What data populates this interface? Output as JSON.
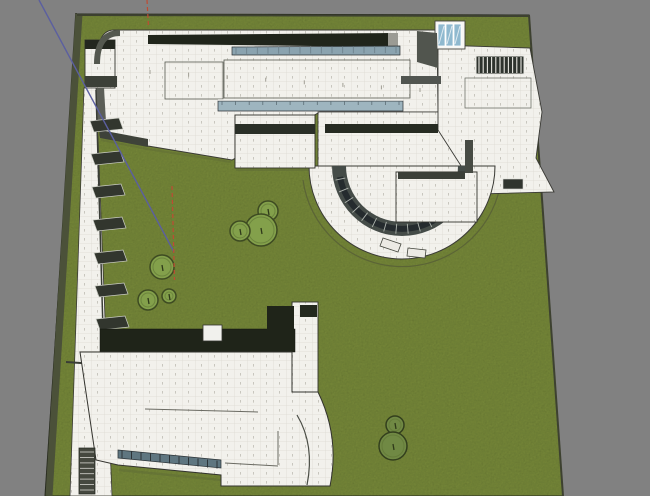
{
  "viewport": {
    "width": 650,
    "height": 496,
    "background_color": "#818181",
    "description": "3d-model-viewport-top-view-museum-site"
  },
  "colors": {
    "grass": "#7c8e3e",
    "site_edge_band": "#4b5139",
    "site_edge_dark": "#2c2f23",
    "tile_white": "#f2f1ec",
    "tile_grid": "#dcdad2",
    "tile_tick": "#b7b4aa",
    "roof_dark": "#20251b",
    "glass_blue_1": "#8aa3af",
    "glass_blue_2": "#9eb5bf",
    "glass_strip_low": "#5f7680",
    "skylight_blue": "#8fb9cf",
    "atrium_glass": "#252b2e",
    "axis_blue": "#5b5fa0",
    "axis_red": "#bf4b33",
    "tree_fill": "#83a04b",
    "tree_stroke": "#3e4b22",
    "tree_dark_fill": "#708944",
    "shadow_green": "#5f6c36"
  },
  "site": {
    "corners": "77,14 529,15 563,496 45,496",
    "edge_band": {
      "d": "M79,14 L49,496",
      "outer": "M76,13 L46,495",
      "top": "M77,15 L529,16",
      "right": "M529,15 L563,496"
    }
  },
  "axes": {
    "blue": {
      "x1": 39,
      "y1": 0,
      "x2": 174,
      "y2": 252
    },
    "red_segments": [
      {
        "x1": 147,
        "y1": 0,
        "x2": 148.5,
        "y2": 27
      },
      {
        "x1": 172,
        "y1": 186,
        "x2": 174.5,
        "y2": 280
      }
    ],
    "red_dash": "4 3"
  },
  "trees": [
    {
      "cx": 268,
      "cy": 211,
      "r": 10,
      "dark": false
    },
    {
      "cx": 261,
      "cy": 230,
      "r": 16,
      "dark": false
    },
    {
      "cx": 240,
      "cy": 231,
      "r": 10,
      "dark": false
    },
    {
      "cx": 162,
      "cy": 267,
      "r": 12,
      "dark": false
    },
    {
      "cx": 148,
      "cy": 300,
      "r": 10,
      "dark": false
    },
    {
      "cx": 169,
      "cy": 296,
      "r": 7,
      "dark": false
    },
    {
      "cx": 395,
      "cy": 425,
      "r": 9,
      "dark": true
    },
    {
      "cx": 393,
      "cy": 446,
      "r": 14,
      "dark": true
    }
  ],
  "shapes": [
    {
      "n": "lawn-shadow-plaza-edge",
      "t": "polyline",
      "a": {
        "points": "101,140 147,149 231,162",
        "fill": "none",
        "stroke": "#5f6c36",
        "stroke-width": "2",
        "opacity": "0.5"
      }
    },
    {
      "n": "lawn-shadow-midblock",
      "t": "line",
      "a": {
        "x1": "236",
        "y1": "170",
        "x2": "315",
        "y2": "170",
        "stroke": "#5f6c36",
        "stroke-width": "2",
        "opacity": "0.5"
      }
    },
    {
      "n": "lawn-shadow-south-wing",
      "t": "line",
      "a": {
        "x1": "119",
        "y1": "470",
        "x2": "221",
        "y2": "480",
        "stroke": "#5f6c36",
        "stroke-width": "2.5",
        "opacity": "0.5"
      }
    },
    {
      "n": "lawn-shadow-rotunda",
      "t": "path",
      "a": {
        "d": "M321,213 A95,95 0 0 0 483,213",
        "fill": "none",
        "stroke": "#5f6c36",
        "stroke-width": "2",
        "opacity": "0.35"
      }
    },
    {
      "n": "rotunda-ground-path",
      "t": "path",
      "a": {
        "d": "M303,180 A100,100 0 0 0 500,187 L526,190",
        "fill": "none",
        "stroke": "#5b6436",
        "stroke-width": "1.2"
      }
    },
    {
      "n": "main-plaza-building",
      "t": "path",
      "a": {
        "d": "M114,30 L437,30 L438,112 L320,112 L232,160 L148,146 L100,136 L97,62 Q97,30 114,30 Z",
        "fill": "url(#tiles)",
        "stroke": "#3a3a35",
        "stroke-width": "0.9"
      }
    },
    {
      "n": "rotunda-upper-plaza",
      "t": "polygon",
      "a": {
        "points": "318,112 460,112 466,173 318,173",
        "fill": "url(#tiles)",
        "stroke": "#3a3a35",
        "stroke-width": "0.8"
      }
    },
    {
      "n": "east-wing-building",
      "t": "path",
      "a": {
        "d": "M438,45 L530,48 L542,112 L536,158 L554,192 L478,194 L465,172 L438,130 Z",
        "fill": "url(#tiles)",
        "stroke": "#3a3a35",
        "stroke-width": "0.9"
      }
    },
    {
      "n": "rotunda-half-disc",
      "t": "path",
      "a": {
        "d": "M309,166 A93,93 0 0 0 495,166 Z",
        "fill": "url(#tiles)",
        "stroke": "#3a3a35",
        "stroke-width": "1"
      }
    },
    {
      "n": "rotunda-glass-annulus",
      "t": "path",
      "a": {
        "d": "M332,166 A70,70 0 0 0 472,166 L458,166 A56,56 0 0 1 346,166 Z",
        "fill": "#454c48",
        "stroke": "none"
      }
    },
    {
      "n": "atrium-glass-arc",
      "t": "path",
      "a": {
        "d": "M340,177 A63,63 0 0 0 464,177",
        "fill": "none",
        "stroke": "#252b2e",
        "stroke-width": "6"
      }
    },
    {
      "n": "atrium-glass-mullions",
      "t": "radial",
      "cx": 402,
      "cy": 166,
      "r1": 58,
      "r2": 68,
      "a1": 168,
      "a2": 12,
      "count": 16,
      "a": {
        "stroke": "#aeb4ae",
        "stroke-width": "0.9"
      }
    },
    {
      "n": "rotunda-balcony-1",
      "t": "polygon",
      "a": {
        "points": "383,238 401,244 398,252 380,246",
        "fill": "#eceae4",
        "stroke": "#44463e",
        "stroke-width": "0.8"
      }
    },
    {
      "n": "rotunda-balcony-2",
      "t": "polygon",
      "a": {
        "points": "408,248 426,250 425,258 407,256",
        "fill": "#eceae4",
        "stroke": "#44463e",
        "stroke-width": "0.8"
      }
    },
    {
      "n": "rotunda-inner-block",
      "t": "rect",
      "a": {
        "x": "396",
        "y": "172",
        "width": "81",
        "height": "50",
        "fill": "url(#tiles)",
        "stroke": "#33332e",
        "stroke-width": "0.9"
      }
    },
    {
      "n": "rotunda-inner-block-roofband",
      "t": "rect",
      "a": {
        "x": "398",
        "y": "172",
        "width": "67",
        "height": "7",
        "fill": "#3b3f38"
      }
    },
    {
      "n": "rotunda-wall-band",
      "t": "rect",
      "a": {
        "x": "465",
        "y": "140",
        "width": "8",
        "height": "33",
        "fill": "#474b44"
      }
    },
    {
      "n": "east-wing-window-box",
      "t": "rect",
      "a": {
        "x": "503",
        "y": "179",
        "width": "20",
        "height": "10",
        "fill": "#30342e",
        "stroke": "#d8d8d2",
        "stroke-width": "0.6"
      }
    },
    {
      "n": "north-roof-dark-band",
      "t": "polygon",
      "a": {
        "points": "148,35 390,33 393,47 148,44",
        "fill": "#20251b"
      }
    },
    {
      "n": "north-roof-band-cap",
      "t": "rect",
      "a": {
        "x": "388",
        "y": "33",
        "width": "10",
        "height": "15",
        "fill": "#9b9b94"
      }
    },
    {
      "n": "clerestory-glass-upper",
      "t": "polygon",
      "a": {
        "points": "232,47 400,46 400,55 232,55",
        "fill": "#8aa3af",
        "stroke": "#2e3335",
        "stroke-width": "0.7"
      }
    },
    {
      "n": "clerestory-upper-mullions",
      "t": "series",
      "tag": "line",
      "count": 16,
      "from": {
        "x1": 236,
        "y1": 47,
        "x2": 236,
        "y2": 54
      },
      "to": {
        "x1": 396,
        "y1": 46,
        "x2": 396,
        "y2": 53
      },
      "a": {
        "stroke": "#6a7e88",
        "stroke-width": "0.8"
      }
    },
    {
      "n": "roof-outline-west",
      "t": "rect",
      "a": {
        "x": "165",
        "y": "62",
        "width": "58",
        "height": "37",
        "fill": "none",
        "stroke": "#55584f",
        "stroke-width": "0.8"
      }
    },
    {
      "n": "roof-outline-east",
      "t": "rect",
      "a": {
        "x": "224",
        "y": "60",
        "width": "186",
        "height": "38",
        "fill": "none",
        "stroke": "#55584f",
        "stroke-width": "0.8"
      }
    },
    {
      "n": "clerestory-glass-lower",
      "t": "polygon",
      "a": {
        "points": "218,101 403,101 403,111 218,111",
        "fill": "#9eb5bf",
        "stroke": "#2c3134",
        "stroke-width": "0.7"
      }
    },
    {
      "n": "clerestory-lower-highlight",
      "t": "line",
      "a": {
        "x1": "218",
        "y1": "100",
        "x2": "403",
        "y2": "100",
        "stroke": "#f5f5f2",
        "stroke-width": "1.4"
      }
    },
    {
      "n": "clerestory-lower-mullions",
      "t": "series",
      "tag": "line",
      "count": 14,
      "from": {
        "x1": 222,
        "y1": 101,
        "x2": 222,
        "y2": 105
      },
      "to": {
        "x1": 399,
        "y1": 101,
        "x2": 399,
        "y2": 105
      },
      "a": {
        "stroke": "#5d6e76",
        "stroke-width": "0.8"
      }
    },
    {
      "n": "south-dark-band-east",
      "t": "rect",
      "a": {
        "x": "325",
        "y": "124",
        "width": "113",
        "height": "9",
        "fill": "#262b22"
      }
    },
    {
      "n": "mid-gallery-block",
      "t": "rect",
      "a": {
        "x": "235",
        "y": "115",
        "width": "80",
        "height": "53",
        "fill": "url(#tiles)",
        "stroke": "#2f2f2a",
        "stroke-width": "0.9"
      }
    },
    {
      "n": "mid-gallery-roofband",
      "t": "rect",
      "a": {
        "x": "235",
        "y": "124",
        "width": "80",
        "height": "10",
        "fill": "#2a2f27"
      }
    },
    {
      "n": "skylight-box",
      "t": "rect",
      "a": {
        "x": "435",
        "y": "21",
        "width": "30",
        "height": "28",
        "fill": "#f7f7f4",
        "stroke": "#44443e",
        "stroke-width": "0.9"
      }
    },
    {
      "n": "skylight-panes",
      "t": "series",
      "tag": "rect",
      "count": 3,
      "from": {
        "x": 438,
        "y": 24,
        "width": 7,
        "height": 22
      },
      "to": {
        "x": 454,
        "y": 24,
        "width": 7,
        "height": 22
      },
      "a": {
        "fill": "#8fb9cf",
        "stroke": "#ffffff",
        "stroke-width": "0.8"
      }
    },
    {
      "n": "skylight-glints",
      "t": "series",
      "tag": "line",
      "count": 3,
      "from": {
        "x1": 444,
        "y1": 26,
        "x2": 439,
        "y2": 44
      },
      "to": {
        "x1": 460,
        "y1": 26,
        "x2": 455,
        "y2": 44
      },
      "a": {
        "stroke": "#dce9f0",
        "stroke-width": "1"
      }
    },
    {
      "n": "dark-wall-wedge",
      "t": "polygon",
      "a": {
        "points": "417,31 437,33 438,68 417,62",
        "fill": "#51554e"
      }
    },
    {
      "n": "louver-pergola",
      "t": "rect",
      "a": {
        "x": "476",
        "y": "56",
        "width": "48",
        "height": "18",
        "fill": "#2e332d",
        "stroke": "#e9e9e3",
        "stroke-width": "1"
      }
    },
    {
      "n": "louver-slats",
      "t": "series",
      "tag": "line",
      "count": 11,
      "from": {
        "x1": 479,
        "y1": 57,
        "x2": 479,
        "y2": 73
      },
      "to": {
        "x1": 521,
        "y1": 57,
        "x2": 521,
        "y2": 73
      },
      "a": {
        "stroke": "#e8e8e2",
        "stroke-width": "1.1"
      }
    },
    {
      "n": "east-wing-band",
      "t": "rect",
      "a": {
        "x": "401",
        "y": "76",
        "width": "40",
        "height": "8",
        "fill": "#515550"
      }
    },
    {
      "n": "east-wing-roof-outline",
      "t": "rect",
      "a": {
        "x": "465",
        "y": "78",
        "width": "66",
        "height": "30",
        "fill": "none",
        "stroke": "#60635a",
        "stroke-width": "0.7"
      }
    },
    {
      "n": "gatehouse-building",
      "t": "rect",
      "a": {
        "x": "85",
        "y": "40",
        "width": "30",
        "height": "48",
        "fill": "url(#tiles)",
        "stroke": "#33332e",
        "stroke-width": "0.9"
      }
    },
    {
      "n": "gatehouse-roofband",
      "t": "rect",
      "a": {
        "x": "85",
        "y": "40",
        "width": "30",
        "height": "9",
        "fill": "#23271f"
      }
    },
    {
      "n": "gatehouse-base-band",
      "t": "rect",
      "a": {
        "x": "85",
        "y": "76",
        "width": "32",
        "height": "11",
        "fill": "#3c4038"
      }
    },
    {
      "n": "gatehouse-wall-wedge",
      "t": "polygon",
      "a": {
        "points": "86,88 104,88 106,122 90,124",
        "fill": "#5c5f58"
      }
    },
    {
      "n": "plaza-corner-wall",
      "t": "path",
      "a": {
        "d": "M97,64 Q97,33 120,33",
        "fill": "none",
        "stroke": "#54584f",
        "stroke-width": "6"
      }
    },
    {
      "n": "plaza-south-wall-band",
      "t": "polygon",
      "a": {
        "points": "100,130 148,139 148,147 100,138",
        "fill": "#3e4239"
      }
    },
    {
      "n": "plaza-joint-ticks",
      "t": "series",
      "tag": "line",
      "count": 8,
      "from": {
        "x1": 150,
        "y1": 70,
        "x2": 150,
        "y2": 74
      },
      "to": {
        "x1": 420,
        "y1": 88,
        "x2": 420,
        "y2": 92
      },
      "a": {
        "stroke": "#a09e94",
        "stroke-width": "1"
      }
    },
    {
      "n": "west-colonnade-wall",
      "t": "polygon",
      "a": {
        "points": "84,88 96,88 112,496 70,496",
        "fill": "url(#tiles)",
        "stroke": "#3a3a35",
        "stroke-width": "0.8"
      }
    },
    {
      "n": "west-colonnade-edge",
      "t": "line",
      "a": {
        "x1": "96",
        "y1": "90",
        "x2": "103",
        "y2": "330",
        "stroke": "#3a3d36",
        "stroke-width": "1.5"
      }
    },
    {
      "n": "colonnade-pergola-1",
      "t": "polygon",
      "a": {
        "points": "90,121 119,118 123,129 94,132",
        "fill": "#32362e",
        "stroke": "#caccc4",
        "stroke-width": "0.7"
      }
    },
    {
      "n": "colonnade-pergola-2",
      "t": "polygon",
      "a": {
        "points": "91,154 120,151 124,162 95,165",
        "fill": "#32362e",
        "stroke": "#caccc4",
        "stroke-width": "0.7"
      }
    },
    {
      "n": "colonnade-pergola-3",
      "t": "polygon",
      "a": {
        "points": "92,187 121,184 125,195 96,198",
        "fill": "#32362e",
        "stroke": "#caccc4",
        "stroke-width": "0.7"
      }
    },
    {
      "n": "colonnade-pergola-4",
      "t": "polygon",
      "a": {
        "points": "93,220 122,217 126,228 97,231",
        "fill": "#32362e",
        "stroke": "#caccc4",
        "stroke-width": "0.7"
      }
    },
    {
      "n": "colonnade-pergola-5",
      "t": "polygon",
      "a": {
        "points": "94,253 123,250 127,261 98,264",
        "fill": "#32362e",
        "stroke": "#caccc4",
        "stroke-width": "0.7"
      }
    },
    {
      "n": "colonnade-pergola-6",
      "t": "polygon",
      "a": {
        "points": "95,286 124,283 128,294 99,297",
        "fill": "#32362e",
        "stroke": "#caccc4",
        "stroke-width": "0.7"
      }
    },
    {
      "n": "colonnade-pergola-7",
      "t": "polygon",
      "a": {
        "points": "96,319 125,316 129,327 100,330",
        "fill": "#32362e",
        "stroke": "#caccc4",
        "stroke-width": "0.7"
      }
    },
    {
      "n": "colonnade-joint-line",
      "t": "line",
      "a": {
        "x1": "66",
        "y1": "362",
        "x2": "140",
        "y2": "367",
        "stroke": "#3a3d36",
        "stroke-width": "2"
      }
    },
    {
      "n": "south-tower",
      "t": "rect",
      "a": {
        "x": "292",
        "y": "302",
        "width": "26",
        "height": "90",
        "fill": "url(#tiles)",
        "stroke": "#33332e",
        "stroke-width": "0.9"
      }
    },
    {
      "n": "south-tower-cap",
      "t": "rect",
      "a": {
        "x": "300",
        "y": "305",
        "width": "17",
        "height": "12",
        "fill": "#23281e"
      }
    },
    {
      "n": "south-building-roof",
      "t": "rect",
      "a": {
        "x": "100",
        "y": "329",
        "width": "195",
        "height": "23",
        "fill": "#1f2419",
        "stroke": "#121510",
        "stroke-width": "0.5"
      }
    },
    {
      "n": "south-building-roof-east",
      "t": "rect",
      "a": {
        "x": "267",
        "y": "306",
        "width": "27",
        "height": "24",
        "fill": "#1f2419"
      }
    },
    {
      "n": "south-roof-notch",
      "t": "rect",
      "a": {
        "x": "203",
        "y": "325",
        "width": "19",
        "height": "16",
        "fill": "#f1f1ed",
        "stroke": "#33332e",
        "stroke-width": "0.8"
      }
    },
    {
      "n": "south-building-body",
      "t": "path",
      "a": {
        "d": "M80,352 L292,352 L292,392 L318,392 Q340,437 330,486 L221,486 L221,475 L118,465 L96,460 Z",
        "fill": "url(#tiles)",
        "stroke": "#33332e",
        "stroke-width": "1"
      }
    },
    {
      "n": "south-wing-inner-curve",
      "t": "path",
      "a": {
        "d": "M297,415 Q315,445 307,485",
        "fill": "none",
        "stroke": "#4a4d45",
        "stroke-width": "1.2"
      }
    },
    {
      "n": "south-body-joint-1",
      "t": "line",
      "a": {
        "x1": "145",
        "y1": "409",
        "x2": "258",
        "y2": "412",
        "stroke": "#6a6a62",
        "stroke-width": "1"
      }
    },
    {
      "n": "south-body-joint-2",
      "t": "line",
      "a": {
        "x1": "225",
        "y1": "463",
        "x2": "278",
        "y2": "466",
        "stroke": "#6a6a62",
        "stroke-width": "1"
      }
    },
    {
      "n": "south-body-joint-3",
      "t": "line",
      "a": {
        "x1": "278",
        "y1": "431",
        "x2": "278",
        "y2": "465",
        "stroke": "#6a6a62",
        "stroke-width": "1"
      }
    },
    {
      "n": "south-glass-strip",
      "t": "polygon",
      "a": {
        "points": "118,450 221,460 221,468 118,458",
        "fill": "#5f7680",
        "stroke": "#2c3438",
        "stroke-width": "0.7"
      }
    },
    {
      "n": "south-glass-mullions",
      "t": "series",
      "tag": "line",
      "count": 11,
      "from": {
        "x1": 122,
        "y1": 450.5,
        "x2": 122,
        "y2": 458.5
      },
      "to": {
        "x1": 217,
        "y1": 460.5,
        "x2": 217,
        "y2": 468.5
      },
      "a": {
        "stroke": "#2c3438",
        "stroke-width": "1"
      }
    },
    {
      "n": "west-stair-block",
      "t": "rect",
      "a": {
        "x": "79",
        "y": "448",
        "width": "16",
        "height": "46",
        "fill": "#45483f",
        "stroke": "#23251f",
        "stroke-width": "0.7"
      }
    },
    {
      "n": "west-stair-steps",
      "t": "series",
      "tag": "line",
      "count": 8,
      "from": {
        "x1": 80,
        "y1": 452,
        "x2": 94,
        "y2": 452
      },
      "to": {
        "x1": 80,
        "y1": 490,
        "x2": 94,
        "y2": 490
      },
      "a": {
        "stroke": "#d5d5cf",
        "stroke-width": "0.8"
      }
    }
  ]
}
